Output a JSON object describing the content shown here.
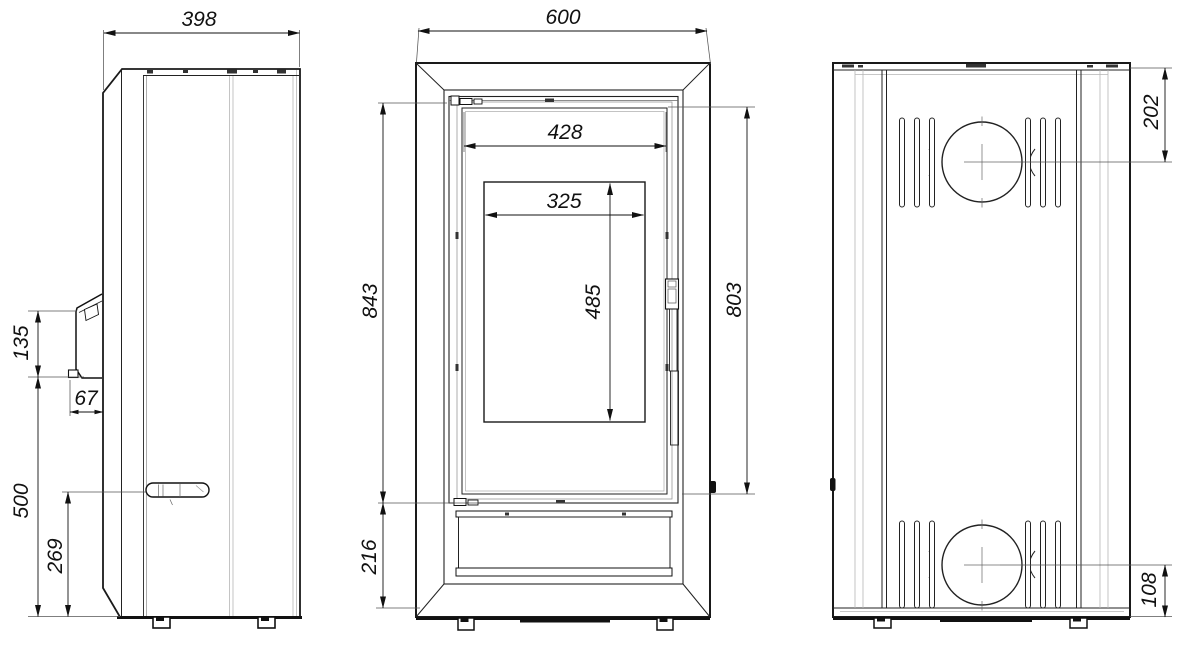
{
  "views": {
    "side": {
      "dims": {
        "depth": "398",
        "handle_length": "135",
        "handle_offset": "67",
        "handle_height": "500",
        "lever_height": "269"
      }
    },
    "front": {
      "dims": {
        "width": "600",
        "glass_width": "428",
        "opening_width": "325",
        "opening_height": "485",
        "upper_height": "843",
        "glass_height": "803",
        "base_height": "216"
      }
    },
    "back": {
      "dims": {
        "flue_from_top": "202",
        "inlet_from_bottom": "108"
      }
    }
  }
}
